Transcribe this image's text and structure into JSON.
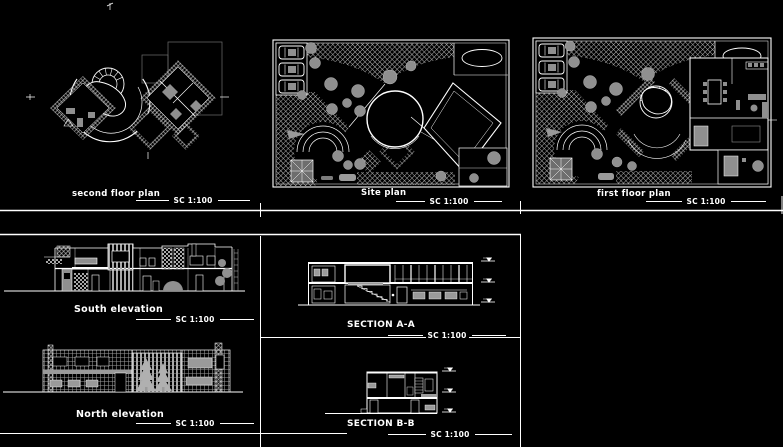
{
  "canvas": {
    "background": "#000000",
    "line_color": "#ffffff",
    "secondary_gray": "#8f8f8f"
  },
  "panels": {
    "second_floor_plan": {
      "title": "second floor plan",
      "scale": "SC 1:100"
    },
    "site_plan": {
      "title": "Site plan",
      "scale": "SC 1:100"
    },
    "first_floor_plan": {
      "title": "first floor plan",
      "scale": "SC 1:100"
    },
    "south_elevation": {
      "title": "South elevation",
      "scale": "SC 1:100"
    },
    "north_elevation": {
      "title": "North elevation",
      "scale": "SC 1:100"
    },
    "section_aa": {
      "title": "SECTION A-A",
      "scale": "SC 1:100"
    },
    "section_bb": {
      "title": "SECTION B-B",
      "scale": "SC 1:100"
    }
  }
}
